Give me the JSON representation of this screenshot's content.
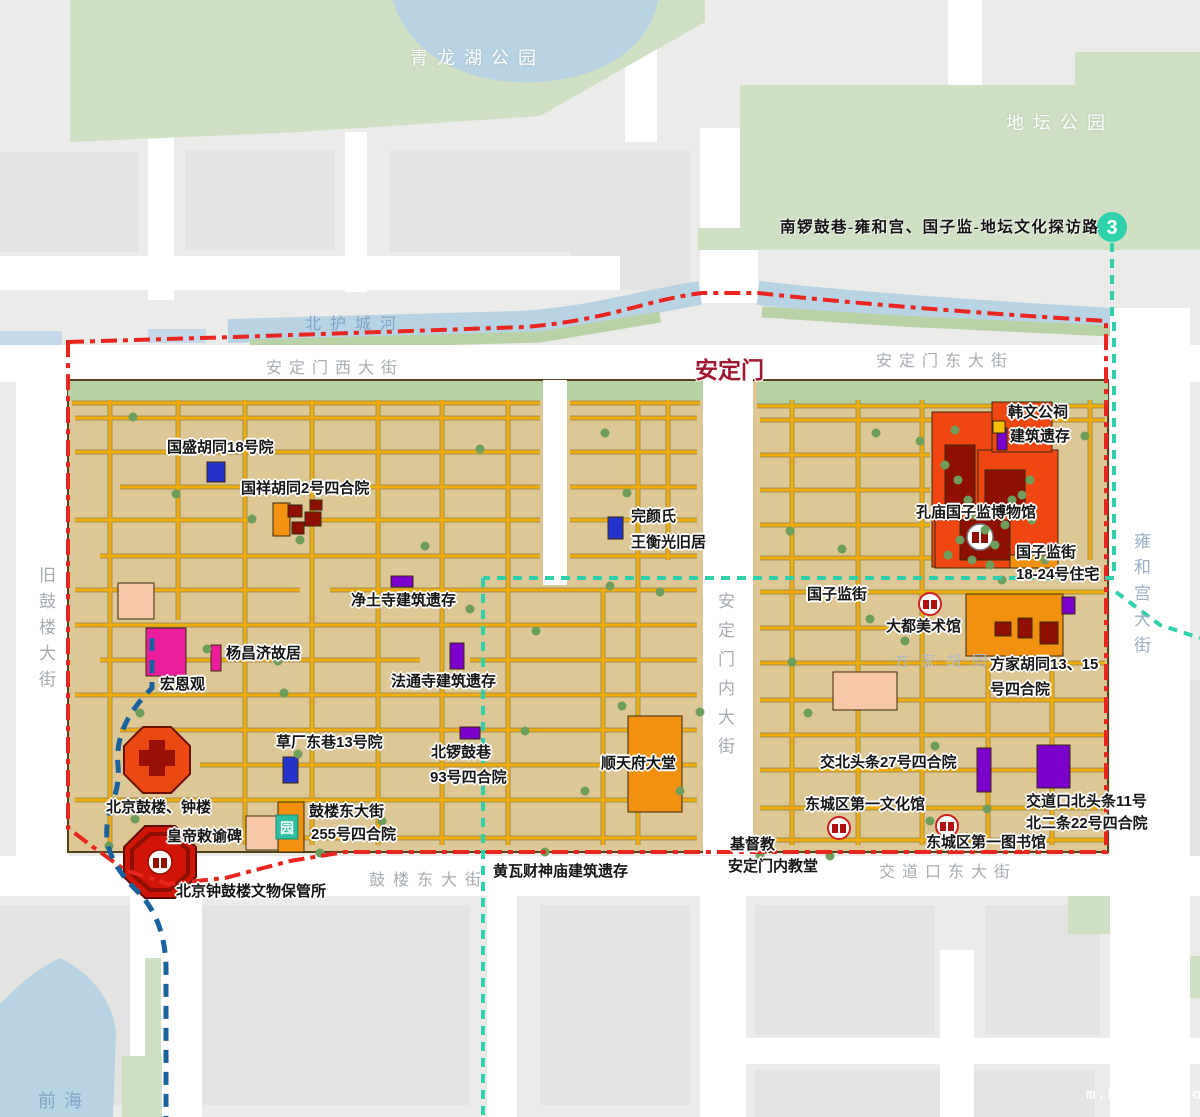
{
  "route": {
    "badge": "3",
    "label": "南锣鼓巷-雍和宫、国子监-地坛文化探访路"
  },
  "gate": {
    "name": "安定门"
  },
  "parks": {
    "qinglonghu": "青龙湖公园",
    "ditan": "地坛公园"
  },
  "water": {
    "north_moat": "北护城河",
    "qianhai": "前海"
  },
  "streets": {
    "andingmen_west": "安定门西大街",
    "andingmen_east": "安定门东大街",
    "andingmen_inner": "安定门内大街",
    "jiugulou": "旧鼓楼大街",
    "yonghegong": "雍和宫大街",
    "gulou_east": "鼓楼东大街",
    "jiaodaokou_east": "交道口东大街",
    "fangjia": "方家胡同"
  },
  "landmarks": {
    "guosheng": "国盛胡同18号院",
    "guoxiang": "国祥胡同2号四合院",
    "wanyan_l1": "完颜氏",
    "wanyan_l2": "王衡光旧居",
    "jingtusi": "净土寺建筑遗存",
    "yangchangji": "杨昌济故居",
    "hongen": "宏恩观",
    "fatongsi": "法通寺建筑遗存",
    "caochang": "草厂东巷13号院",
    "beiluogu_l1": "北锣鼓巷",
    "beiluogu_l2": "93号四合院",
    "shuntianfu": "顺天府大堂",
    "gulou255_l1": "鼓楼东大街",
    "gulou255_l2": "255号四合院",
    "gulou_zhonglou": "北京鼓楼、钟楼",
    "huangdi_bei": "皇帝敕谕碑",
    "wenwu_baoguansuo": "北京钟鼓楼文物保管所",
    "huangwa": "黄瓦财神庙建筑遗存",
    "jidujiao_l1": "基督教",
    "jidujiao_l2": "安定门内教堂",
    "wenhuaguan": "东城区第一文化馆",
    "tushuguan": "东城区第一图书馆",
    "jiaobei27": "交北头条27号四合院",
    "jiaodaokou11_l1": "交道口北头条11号",
    "jiaodaokou11_l2": "北二条22号四合院",
    "guozijian_jie": "国子监街",
    "dadu": "大都美术馆",
    "fangjia1315_l1": "方家胡同13、15",
    "fangjia1315_l2": "号四合院",
    "kongmiao": "孔庙国子监博物馆",
    "guozijian1824_l1": "国子监街",
    "guozijian1824_l2": "18-24号住宅",
    "hanwen_l1": "韩文公祠",
    "hanwen_l2": "建筑遗存"
  },
  "icons": {
    "garden_char": "园"
  },
  "watermark": "m.ktxcqx.com",
  "colors": {
    "boundary_red": "#e8251f",
    "route_teal": "#2fd1ac",
    "route_blue": "#19629e",
    "district_tan": "#dcc795",
    "hutong_gold": "#f1ad08",
    "park_green": "#cfe0c4",
    "water_blue": "#b7d3e4",
    "building_orange_red": "#ef4612",
    "building_dark_red": "#8f1000",
    "building_orange": "#f29110",
    "building_purple": "#7c00cb",
    "building_magenta": "#eb1d9d",
    "building_pink": "#f7c8a8",
    "building_blue": "#2333cc",
    "gate_label_red": "#a01730"
  }
}
